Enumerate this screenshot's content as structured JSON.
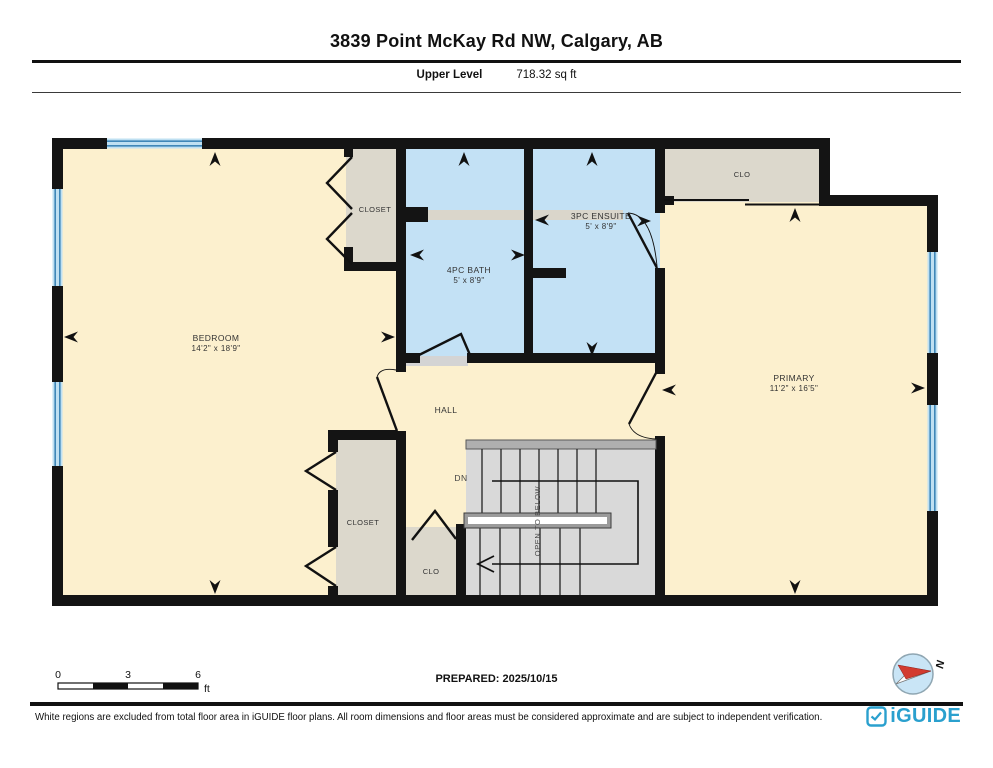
{
  "header": {
    "title": "3839 Point McKay Rd NW, Calgary, AB",
    "level": "Upper Level",
    "area": "718.32 sq ft"
  },
  "plan": {
    "rooms": {
      "bedroom": {
        "name": "BEDROOM",
        "dims": "14'2\" x 18'9\""
      },
      "closet_top": {
        "name": "CLOSET"
      },
      "bath": {
        "name": "4PC BATH",
        "dims": "5' x 8'9\""
      },
      "ensuite": {
        "name": "3PC ENSUITE",
        "dims": "5' x 8'9\""
      },
      "clo_top": {
        "name": "CLO"
      },
      "primary": {
        "name": "PRIMARY",
        "dims": "11'2\" x 16'5\""
      },
      "hall": {
        "name": "HALL"
      },
      "closet_hall": {
        "name": "CLOSET"
      },
      "clo_bottom": {
        "name": "CLO"
      }
    },
    "stairs": {
      "down_label": "DN",
      "open_label": "OPEN TO BELOW"
    },
    "compass": {
      "north_label": "N"
    }
  },
  "scalebar": {
    "tick0": "0",
    "tick1": "3",
    "tick2": "6",
    "unit": "ft"
  },
  "prepared": "PREPARED: 2025/10/15",
  "footer": {
    "disclaimer": "White regions are excluded from total floor area in iGUIDE floor plans. All room dimensions and floor areas must be considered approximate and are subject to independent verification.",
    "brand": "iGUIDE"
  },
  "colors": {
    "room_fill": "#FCF0CE",
    "wet_room_fill": "#C3E1F5",
    "closet_fill": "#DCD8CC",
    "stairs_fill": "#D9D9D9",
    "wall": "#141414",
    "window_line": "#3F87B8",
    "window_fill": "#BFE0F2",
    "brand_teal": "#2AA0CE",
    "compass_red": "#D23B2F"
  }
}
